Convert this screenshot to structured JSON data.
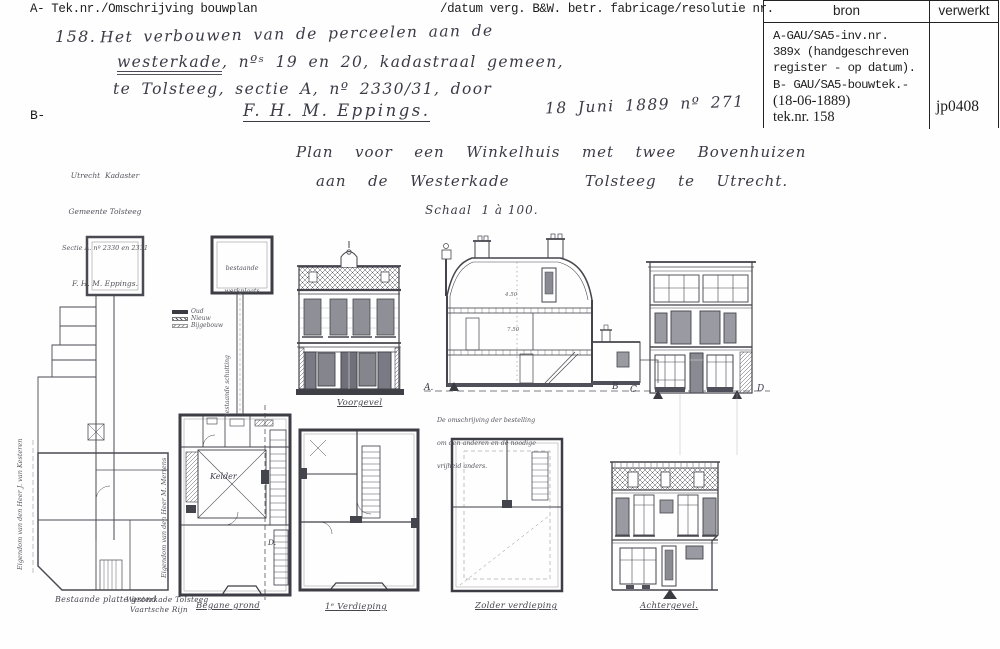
{
  "header": {
    "left": "A- Tek.nr./Omschrijving bouwplan",
    "right": "/datum verg. B&W. betr. fabricage/resolutie nr.",
    "b_prefix": "B-"
  },
  "register": {
    "col_bron": "bron",
    "col_verwerkt": "verwerkt",
    "bron_lines": [
      "A-GAU/SA5-inv.nr.",
      "389x (handgeschreven",
      "register - op datum).",
      "B- GAU/SA5-bouwtek.-",
      "(18-06-1889)",
      "tek.nr. 158"
    ],
    "verwerkt": "jp0408"
  },
  "entry": {
    "number": "158.",
    "line1": "Het verbouwen van de perceelen aan de",
    "line2_word": "westerkade",
    "line2_rest": ", nºˢ 19 en 20, kadastraal gemeen,",
    "line3": "te Tolsteeg, sectie A, nº 2330/31, door",
    "applicant": "F. H. M. Eppings.",
    "date_ref": "18 Juni 1889 nº 271"
  },
  "kadaster_note": {
    "line1": "Utrecht  Kadaster",
    "line2": "Gemeente Tolsteeg",
    "line3": "Sectie A. nº 2330 en 2331",
    "line4": "F. H. M. Eppings."
  },
  "plan_title": {
    "line1": "Plan  voor  een  Winkelhuis  met  twee  Bovenhuizen",
    "line2": "aan  de  Westerkade       Tolsteeg  te  Utrecht.",
    "scale": "Schaal  1 à 100."
  },
  "legend": {
    "item1": "Oud",
    "item2": "Nieuw",
    "item3": "Bijgebouw"
  },
  "labels": {
    "bestaande_plattegrond": "Bestaande platte grond",
    "westerkade": "Westerkade Tolsteeg",
    "vaartsche_rijn": "Vaartsche Rijn",
    "begane_grond": "Begane grond",
    "voorgevel": "Voorgevel",
    "verdieping1": "1ᵉ Verdieping",
    "zolder": "Zolder verdieping",
    "achtergevel": "Achtergevel.",
    "kelder": "Kelder",
    "werkplaats_l1": "bestaande",
    "werkplaats_l2": "werkplaats",
    "schutting": "bestaande schutting",
    "eigendom_links": "Eigendom van den Heer J. van Kesteren",
    "eigendom_midden": "Eigendom van den Heer M. Mertens",
    "note_l1": "De omschrijving der bestelling",
    "note_l2": "om den anderen en de noodige",
    "note_l3": "vrijheid anders.",
    "marker_a": "A.",
    "marker_b": "B",
    "marker_c": "C",
    "marker_d": "D",
    "marker_d2": "D.",
    "dim_upper": "4.50",
    "dim_lower": "7.50"
  }
}
